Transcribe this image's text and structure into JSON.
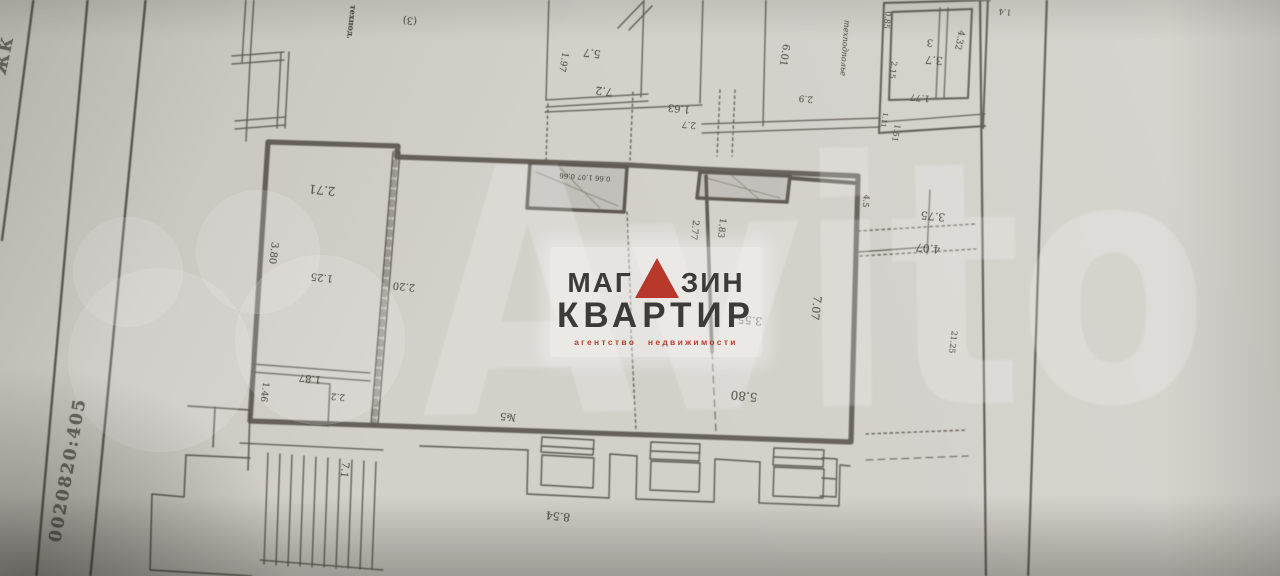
{
  "logo": {
    "line1_prefix": "МАГ",
    "line1_suffix": "ЗИН",
    "line2": "КВАРТИР",
    "tagline": "агентство недвижимости",
    "text_color": "#3d3a38",
    "accent_color": "#b8392c"
  },
  "watermark": {
    "text": "Avito",
    "color": "#ffffff",
    "circles": [
      {
        "cx": 128,
        "cy": 272,
        "r": 55
      },
      {
        "cx": 258,
        "cy": 252,
        "r": 62
      },
      {
        "cx": 160,
        "cy": 360,
        "r": 92
      },
      {
        "cx": 320,
        "cy": 340,
        "r": 85
      }
    ]
  },
  "paper": {
    "base_color": "#d3d0ca",
    "ink_color": "#49433d"
  },
  "margin_notes": {
    "cadastral_fragment": "0020820:405",
    "corner_fragment": "ЖК"
  },
  "plan": {
    "annotations": [
      {
        "text": "техпод.",
        "x": 352,
        "y": 22,
        "rot": 96,
        "fs": 8,
        "cls": "bold"
      },
      {
        "text": "(3)",
        "x": 410,
        "y": 20,
        "rot": 185,
        "fs": 10,
        "cls": ""
      },
      {
        "text": "1.97",
        "x": 563,
        "y": 62,
        "rot": 100,
        "fs": 9,
        "cls": ""
      },
      {
        "text": "5.7",
        "x": 592,
        "y": 53,
        "rot": 187,
        "fs": 11,
        "cls": ""
      },
      {
        "text": "7.2",
        "x": 604,
        "y": 91,
        "rot": 187,
        "fs": 11,
        "cls": ""
      },
      {
        "text": "1.63",
        "x": 679,
        "y": 108,
        "rot": 186,
        "fs": 10,
        "cls": ""
      },
      {
        "text": "2.7",
        "x": 689,
        "y": 124,
        "rot": 186,
        "fs": 9,
        "cls": ""
      },
      {
        "text": "6.01",
        "x": 784,
        "y": 55,
        "rot": 99,
        "fs": 10,
        "cls": ""
      },
      {
        "text": "2.9",
        "x": 806,
        "y": 98,
        "rot": 186,
        "fs": 9,
        "cls": ""
      },
      {
        "text": "техподполье",
        "x": 845,
        "y": 48,
        "rot": 94,
        "fs": 8,
        "cls": "it"
      },
      {
        "text": "0.85",
        "x": 887,
        "y": 20,
        "rot": 98,
        "fs": 8,
        "cls": ""
      },
      {
        "text": "2.15",
        "x": 893,
        "y": 70,
        "rot": 98,
        "fs": 8,
        "cls": ""
      },
      {
        "text": "3",
        "x": 930,
        "y": 42,
        "rot": 186,
        "fs": 10,
        "cls": ""
      },
      {
        "text": "3.7",
        "x": 934,
        "y": 60,
        "rot": 186,
        "fs": 11,
        "cls": ""
      },
      {
        "text": "1.4",
        "x": 1005,
        "y": 12,
        "rot": 186,
        "fs": 8,
        "cls": ""
      },
      {
        "text": "4.32",
        "x": 959,
        "y": 40,
        "rot": 102,
        "fs": 9,
        "cls": ""
      },
      {
        "text": "1.77",
        "x": 920,
        "y": 97,
        "rot": 186,
        "fs": 9,
        "cls": ""
      },
      {
        "text": "1.11",
        "x": 884,
        "y": 120,
        "rot": 100,
        "fs": 7,
        "cls": ""
      },
      {
        "text": "1.51",
        "x": 896,
        "y": 133,
        "rot": 100,
        "fs": 8,
        "cls": ""
      },
      {
        "text": "2.71",
        "x": 322,
        "y": 190,
        "rot": 186,
        "fs": 12,
        "cls": ""
      },
      {
        "text": "3.80",
        "x": 273,
        "y": 253,
        "rot": 97,
        "fs": 10,
        "cls": ""
      },
      {
        "text": "1.25",
        "x": 322,
        "y": 277,
        "rot": 186,
        "fs": 10,
        "cls": ""
      },
      {
        "text": "2.20",
        "x": 404,
        "y": 286,
        "rot": 186,
        "fs": 10,
        "cls": ""
      },
      {
        "text": "0.66 1.07 0.66",
        "x": 585,
        "y": 177,
        "rot": 184,
        "fs": 7,
        "cls": ""
      },
      {
        "text": "2.77",
        "x": 694,
        "y": 230,
        "rot": 97,
        "fs": 9,
        "cls": ""
      },
      {
        "text": "1.83",
        "x": 721,
        "y": 228,
        "rot": 97,
        "fs": 9,
        "cls": ""
      },
      {
        "text": "3.55",
        "x": 750,
        "y": 320,
        "rot": 186,
        "fs": 11,
        "cls": ""
      },
      {
        "text": "7.07",
        "x": 816,
        "y": 308,
        "rot": 97,
        "fs": 11,
        "cls": ""
      },
      {
        "text": "1.87",
        "x": 310,
        "y": 378,
        "rot": 186,
        "fs": 10,
        "cls": ""
      },
      {
        "text": "2.2",
        "x": 338,
        "y": 396,
        "rot": 186,
        "fs": 9,
        "cls": ""
      },
      {
        "text": "1.46",
        "x": 264,
        "y": 392,
        "rot": 97,
        "fs": 9,
        "cls": ""
      },
      {
        "text": "7.1",
        "x": 344,
        "y": 470,
        "rot": 97,
        "fs": 10,
        "cls": ""
      },
      {
        "text": "№5",
        "x": 508,
        "y": 416,
        "rot": 186,
        "fs": 10,
        "cls": ""
      },
      {
        "text": "5.80",
        "x": 744,
        "y": 396,
        "rot": 186,
        "fs": 12,
        "cls": ""
      },
      {
        "text": "8.54",
        "x": 558,
        "y": 516,
        "rot": 186,
        "fs": 11,
        "cls": ""
      },
      {
        "text": "4.5",
        "x": 866,
        "y": 201,
        "rot": 97,
        "fs": 8,
        "cls": ""
      },
      {
        "text": "3.75",
        "x": 933,
        "y": 216,
        "rot": 186,
        "fs": 11,
        "cls": ""
      },
      {
        "text": "4.07",
        "x": 928,
        "y": 248,
        "rot": 186,
        "fs": 11,
        "cls": ""
      },
      {
        "text": "21.25",
        "x": 953,
        "y": 342,
        "rot": 97,
        "fs": 8,
        "cls": ""
      }
    ]
  }
}
